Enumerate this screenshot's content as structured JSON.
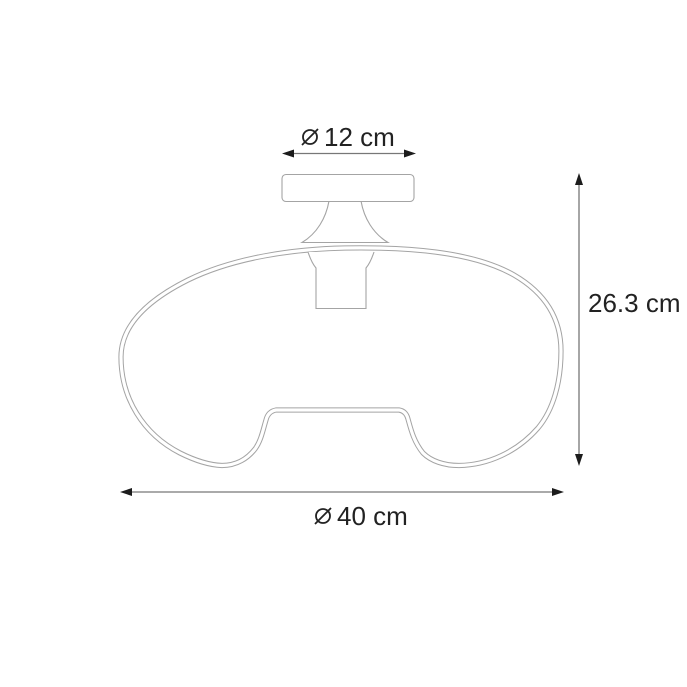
{
  "diagram": {
    "title": "ceiling-lamp-dimension-drawing",
    "labels": {
      "canopy_diameter": "12 cm",
      "height": "26.3 cm",
      "shade_diameter": "40 cm",
      "diameter_symbol": "⌀"
    },
    "colors": {
      "background": "#ffffff",
      "lamp_line": "#a4a4a4",
      "dimension_line": "#777777",
      "arrowhead": "#1c1c1c",
      "text": "#222222"
    }
  }
}
